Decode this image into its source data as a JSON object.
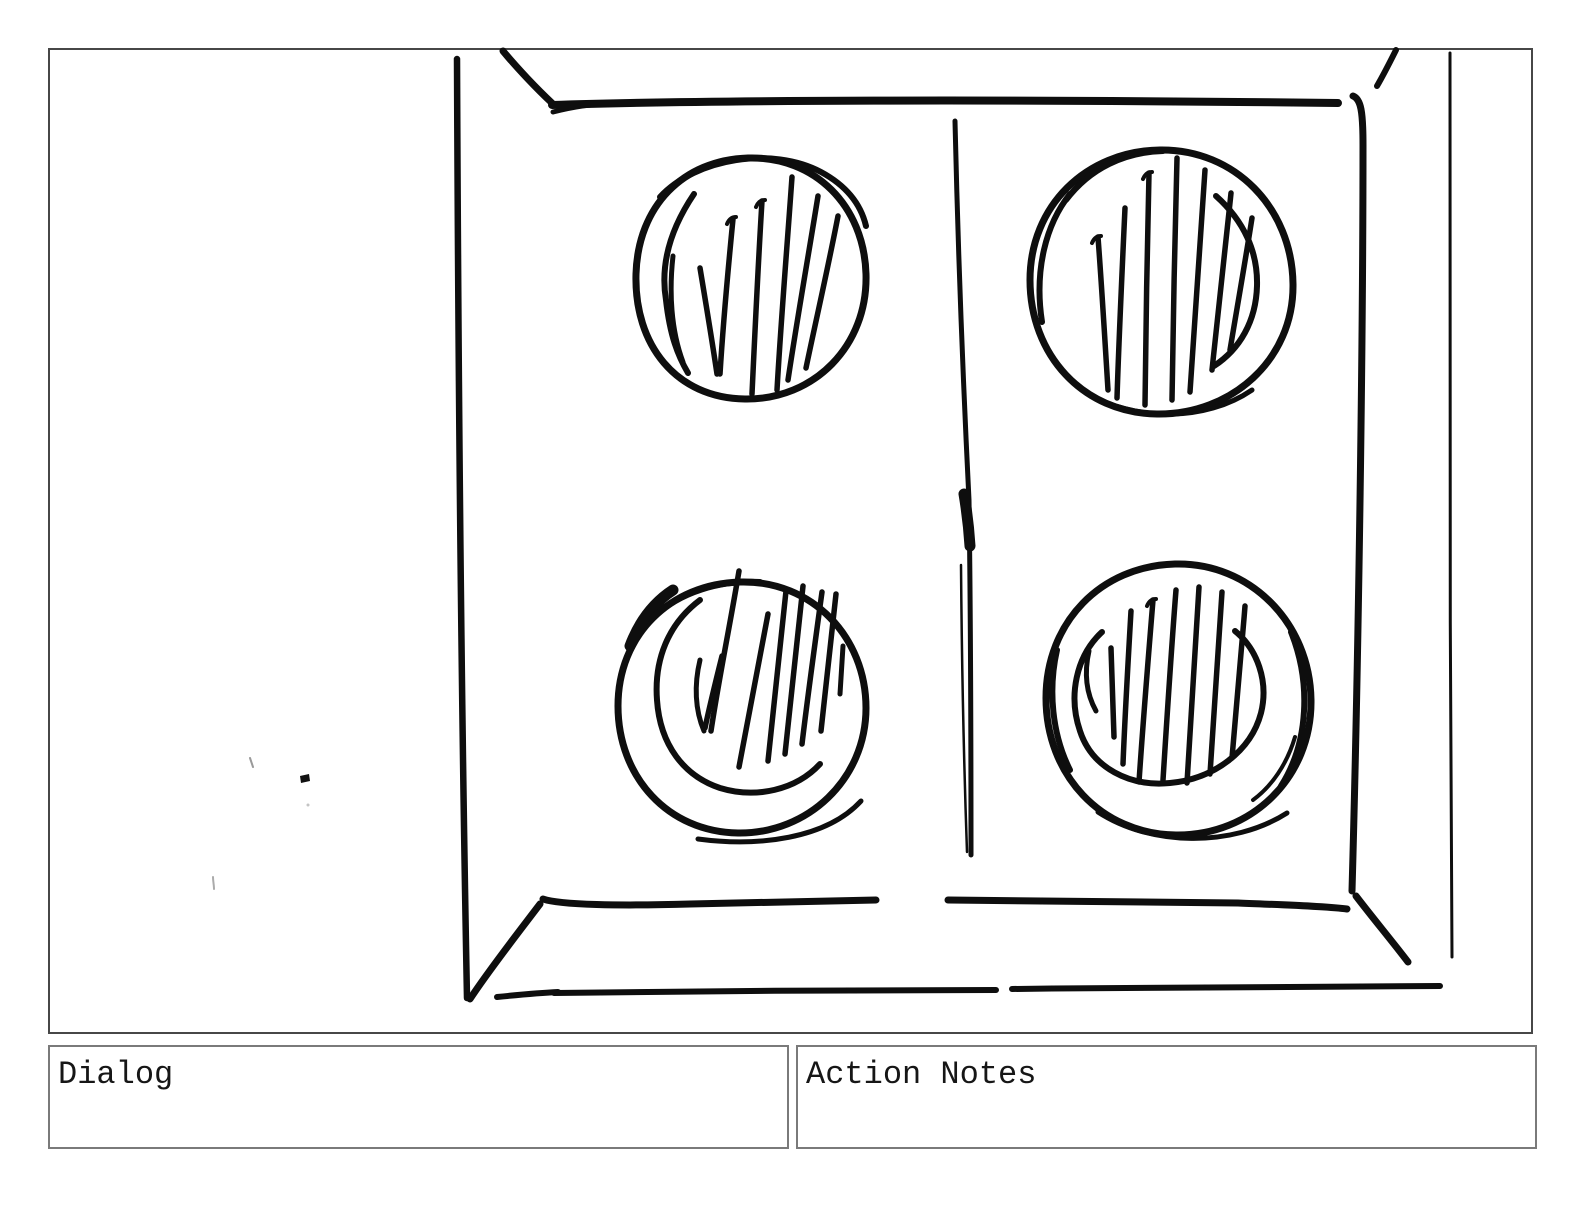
{
  "page": {
    "background_color": "#ffffff"
  },
  "panel": {
    "border_color": "#474747",
    "content": "hand-drawn storyboard sketch"
  },
  "sketch": {
    "name": "open-window-frame-with-four-hatched-circles",
    "ink_color": "#0e0e0e",
    "elements": [
      "outer window frame in slight perspective",
      "center mullion divider",
      "four circles with diagonal hatching, one per pane quadrant",
      "small stray ink dot and faint tick marks at left"
    ]
  },
  "boxes": {
    "dialog_label": "Dialog",
    "action_notes_label": "Action Notes",
    "border_color": "#7a7a7a",
    "text_color": "#161616"
  }
}
